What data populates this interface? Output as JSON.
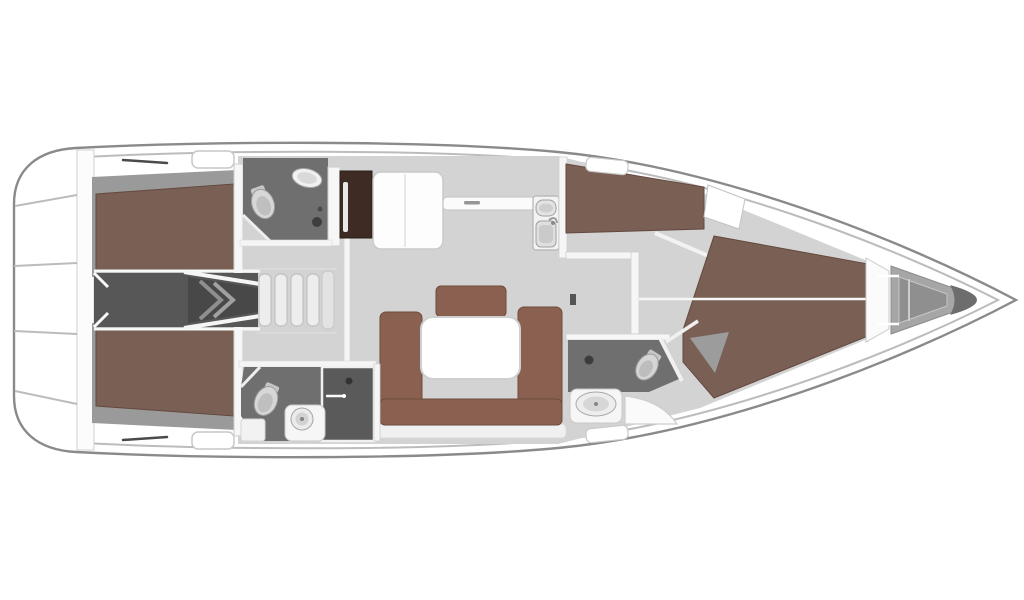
{
  "meta": {
    "description": "Top-down interior layout plan of a sailing yacht rendered in 3D on a white background; stern with swim platform at left, pointed bow at right",
    "width": 1024,
    "height": 600,
    "background": "#ffffff"
  },
  "colors": {
    "background": "#ffffff",
    "hull_stroke": "#8a8a8a",
    "deck_line": "#bcbcbc",
    "wall": "#f6f6f6",
    "wall_stroke": "#cfcfcf",
    "floor": "#d3d3d3",
    "cabin_shadow": "#9a9a9a",
    "berth": "#7a6054",
    "berth_edge": "#63493e",
    "sofa": "#8a6150",
    "sofa_edge": "#6f4a3b",
    "table": "#ffffff",
    "table_stroke": "#cfcfcf",
    "cabinet": "#3d2b24",
    "head_floor": "#6f6f6f",
    "shower_floor": "#5a5a5a",
    "corridor": "#575757",
    "corridor_dark": "#484848",
    "chevron": "#8f8f8f",
    "locker": "#a6a6a6",
    "locker_inner": "#8f8f8f",
    "bow_tip": "#6d6d6d",
    "hatch_line": "#4a4a4a"
  },
  "vessel": {
    "view": "top-down interior floor plan",
    "orientation": {
      "stern": "left",
      "bow": "right"
    },
    "regions": [
      {
        "id": "swim-platform",
        "name": "stern swim platform and transom"
      },
      {
        "id": "aft-cabin-starboard",
        "name": "aft double cabin with berth (top)"
      },
      {
        "id": "aft-cabin-port",
        "name": "aft double cabin with berth (bottom)"
      },
      {
        "id": "engine-compartment",
        "name": "engine compartment corridor between aft cabins"
      },
      {
        "id": "companionway",
        "name": "companionway entry steps"
      },
      {
        "id": "aft-head-starboard",
        "name": "aft head with toilet and basin (top)"
      },
      {
        "id": "aft-head-port",
        "name": "aft head with toilet, basin and shower stall (bottom)"
      },
      {
        "id": "galley",
        "name": "galley with stove cabinet, L-shaped counter and twin sink"
      },
      {
        "id": "salon",
        "name": "salon with U-shaped settee and white table"
      },
      {
        "id": "side-cabin-starboard",
        "name": "forward side berth cabin (top)"
      },
      {
        "id": "forward-head",
        "name": "forward head with toilet, basin and door"
      },
      {
        "id": "forward-cabin",
        "name": "forward V-berth cabin"
      },
      {
        "id": "anchor-locker",
        "name": "bow anchor locker"
      }
    ]
  }
}
